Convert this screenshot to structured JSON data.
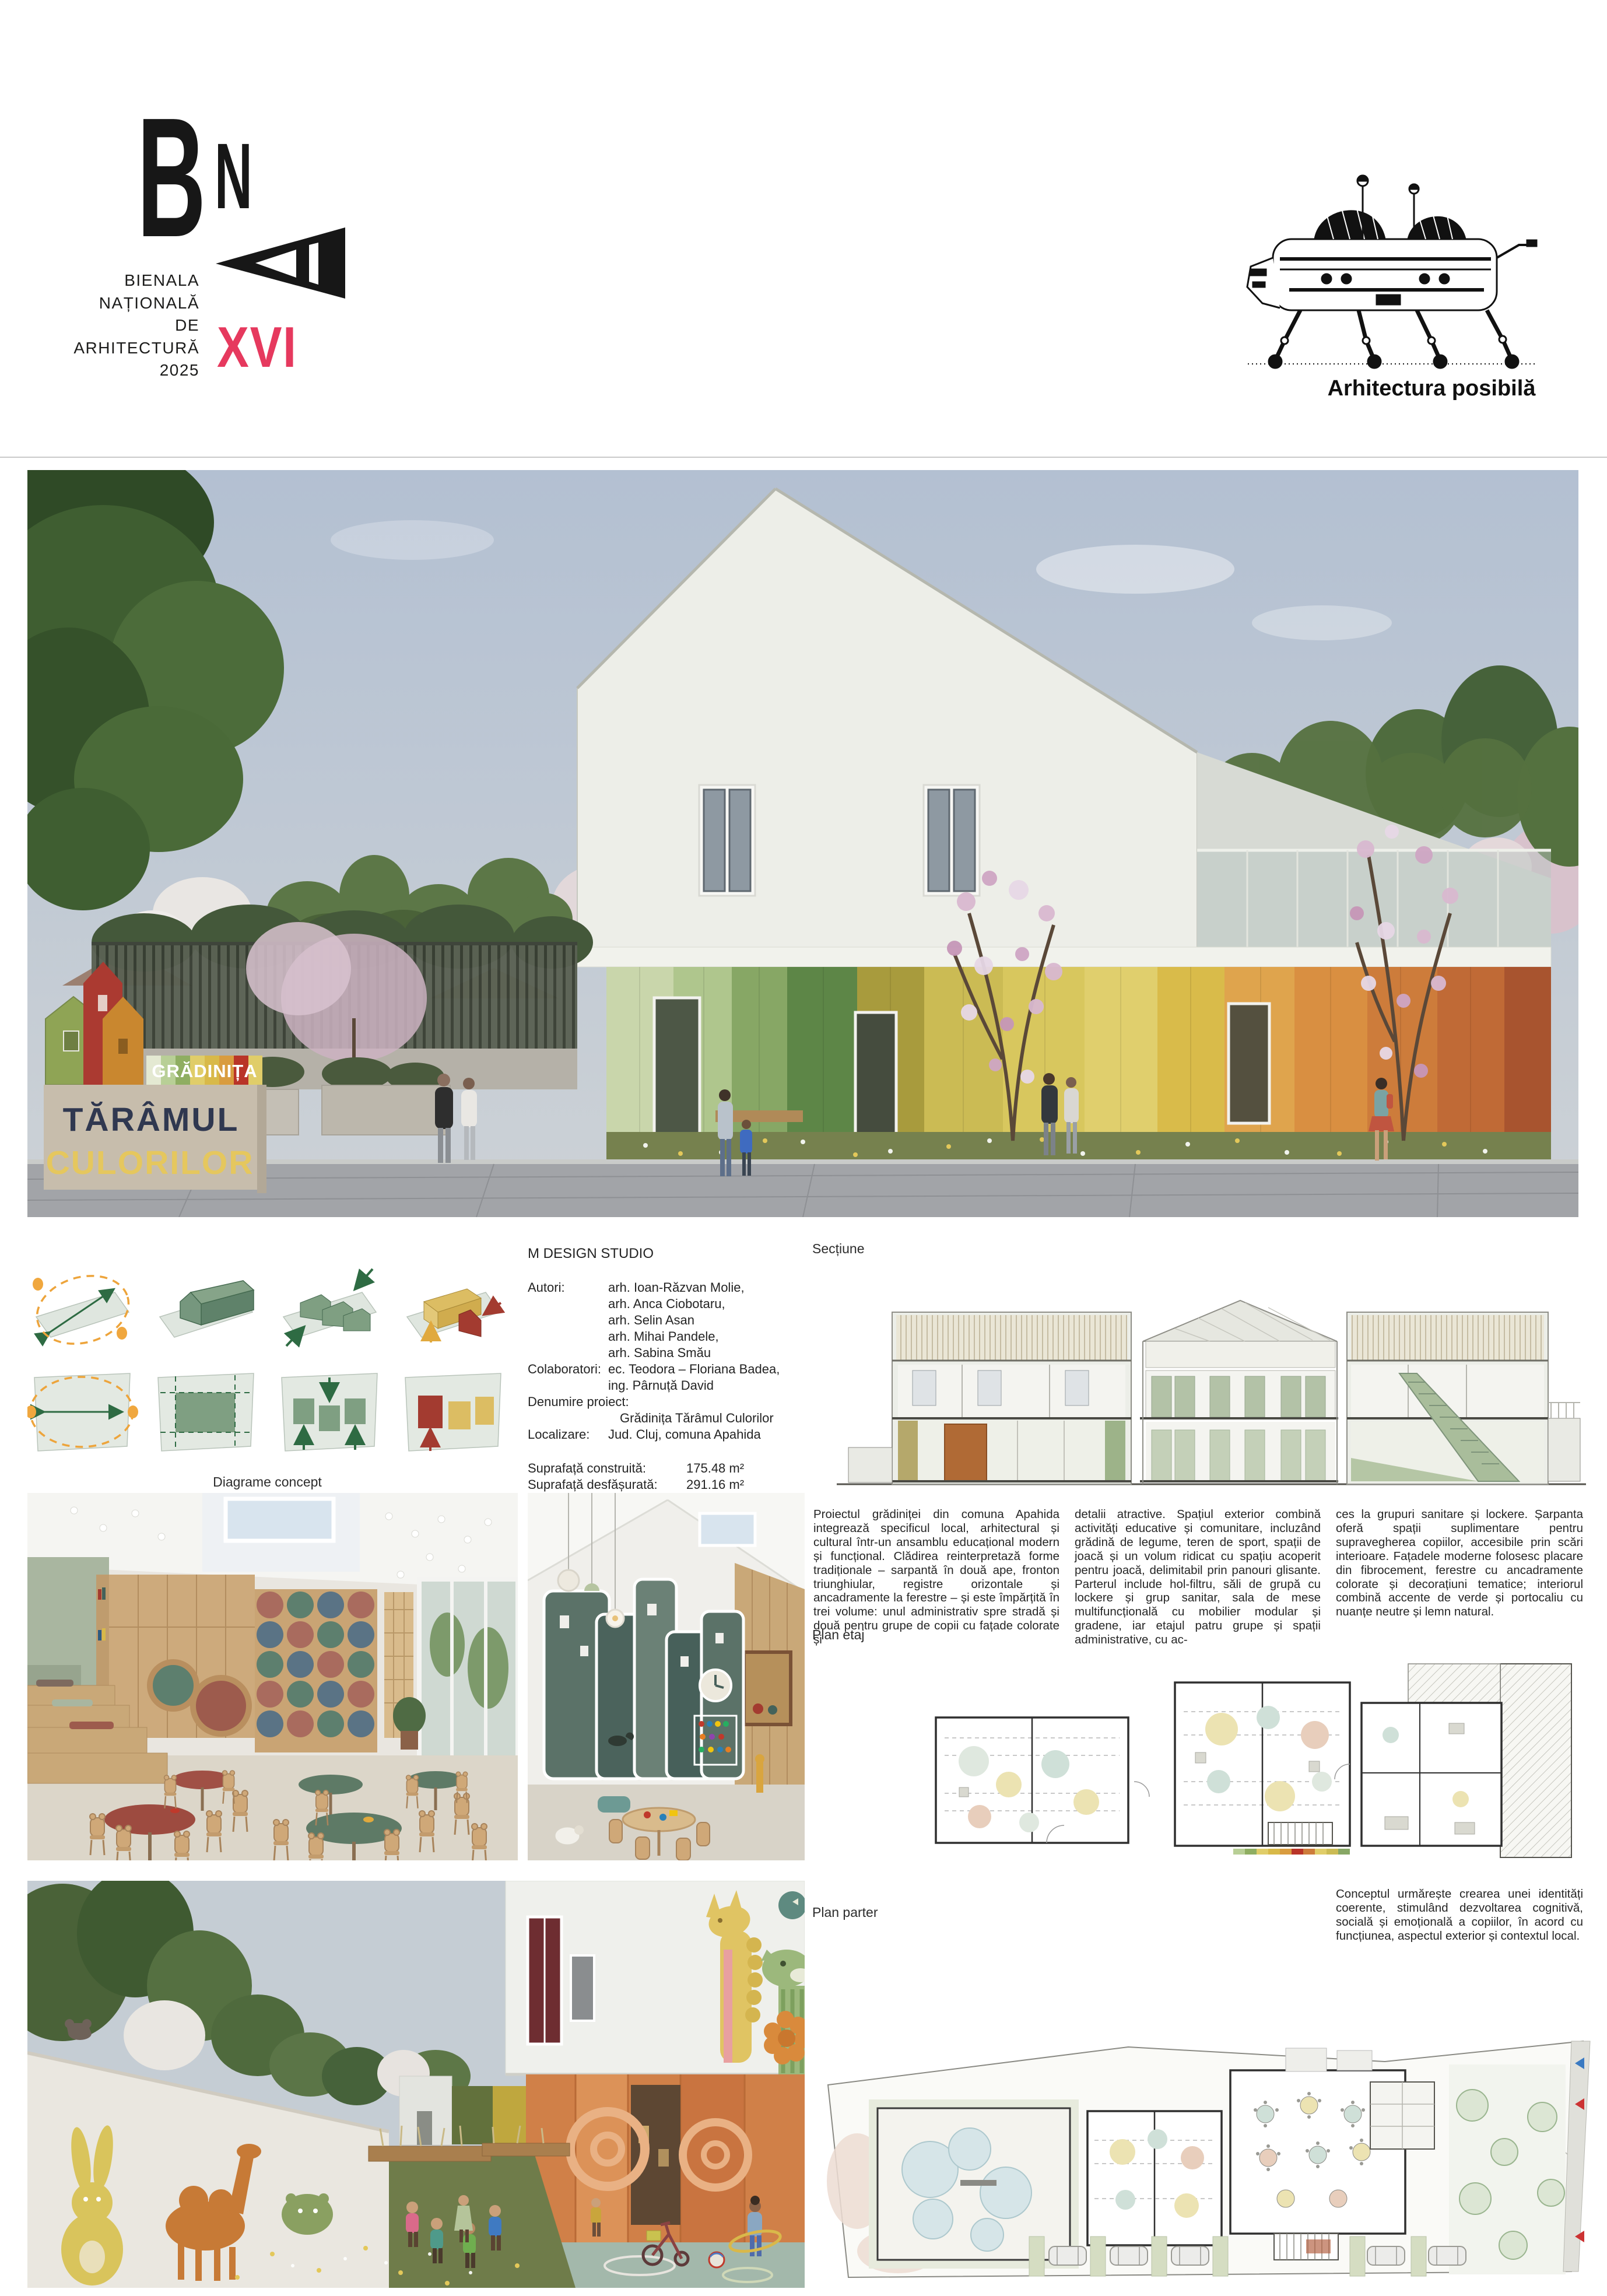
{
  "header": {
    "logo": {
      "letters": [
        "B",
        "N",
        "A"
      ],
      "lines": [
        "BIENALA",
        "NAȚIONALĂ",
        "DE",
        "ARHITECTURĂ",
        "2025"
      ],
      "edition": "XVI",
      "accent_color": "#e6395e"
    },
    "right_logo": {
      "caption": "Arhitectura posibilă"
    }
  },
  "hero": {
    "sign": {
      "top": "GRĂDINIȚA",
      "line1": "TĂRÂMUL",
      "line2": "CULORILOR"
    },
    "sign_colors": {
      "navy": "#303850",
      "yellow": "#e5c75e",
      "board": "#c7bdac"
    },
    "facade_palette": [
      "#c9d6ab",
      "#afc68d",
      "#87a765",
      "#5d8647",
      "#a89b3d",
      "#cbbb54",
      "#d8c75e",
      "#e0cf6d",
      "#d9bb4a",
      "#dfa44d",
      "#d98f41",
      "#cd7c3b",
      "#c06a36",
      "#a8542f"
    ]
  },
  "info": {
    "studio": "M DESIGN STUDIO",
    "authors_label": "Autori:",
    "authors": [
      "arh. Ioan-Răzvan Molie,",
      "arh. Anca Ciobotaru,",
      "arh. Selin Asan",
      "arh. Mihai Pandele,",
      "arh. Sabina Smău"
    ],
    "collaborators_label": "Colaboratori:",
    "collaborators": [
      "ec. Teodora – Floriana Badea,",
      "ing. Pârnuță David"
    ],
    "project_label": "Denumire proiect:",
    "project_name": "Grădinița Tărâmul Culorilor",
    "location_label": "Localizare:",
    "location": "Jud. Cluj, comuna Apahida",
    "metrics": [
      {
        "label": "Suprafață construită:",
        "value": "175.48 m²"
      },
      {
        "label": "Suprafață desfășurată:",
        "value": "291.16 m²"
      },
      {
        "label": "P.O.T.:",
        "value": "30.00%"
      },
      {
        "label": "C.U.T.:",
        "value": "0.50"
      },
      {
        "label": "Regim de înălțime:",
        "value": "P+E"
      }
    ]
  },
  "labels": {
    "diagrams": "Diagrame concept",
    "section": "Secțiune",
    "plan_floor": "Plan etaj",
    "plan_ground": "Plan parter"
  },
  "paragraphs": {
    "col1": "Proiectul grădiniței din comuna Apahida integrează specificul local, arhitectural și cultural într-un ansamblu educațional modern și funcțional. Clădirea reinterpretază forme tradiționale – sarpantă în două ape, fronton triunghiular, registre orizontale și ancadramente la ferestre – și este împărțită în trei volume: unul administrativ spre stradă și două pentru grupe de copii cu fațade colorate și",
    "col2": "detalii atractive. Spațiul exterior combină activități educative și comunitare, incluzând grădină de legume, teren de sport, spații de joacă și un volum ridicat cu spațiu acoperit pentru joacă, delimitabil prin panouri glisante. Parterul include hol-filtru, săli de grupă cu lockere și grup sanitar, sala de mese multifuncțională cu mobilier modular și gradene, iar etajul patru grupe și spații administrative, cu ac-",
    "col3": "ces la grupuri sanitare și lockere. Șarpanta oferă spații suplimentare pentru supravegherea copiilor, accesibile prin scări interioare. Fațadele moderne folosesc placare din fibrocement, ferestre cu ancadramente colorate și decorațiuni tematice; interiorul combină accente de verde și portocaliu cu nuanțe neutre și lemn natural.",
    "concept": "Conceptul urmărește crearea unei identități coerente, stimulând dezvoltarea cognitivă, socială și emoțională a copiilor, în acord cu funcțiunea, aspectul exterior și contextul local."
  }
}
